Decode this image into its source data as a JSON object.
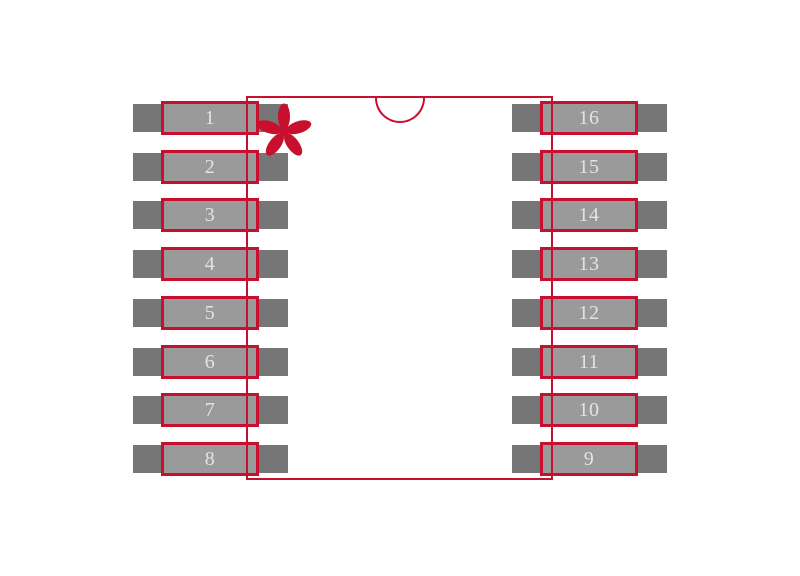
{
  "figure": {
    "left_pins": [
      "1",
      "2",
      "3",
      "4",
      "5",
      "6",
      "7",
      "8"
    ],
    "right_pins": [
      "16",
      "15",
      "14",
      "13",
      "12",
      "11",
      "10",
      "9"
    ],
    "pin1_marker_glyph": "*"
  },
  "icons": {
    "pin1_marker": "asterisk-icon",
    "pin1_end_indicator": "notch-half-circle"
  },
  "colors": {
    "background": "#ffffff",
    "annotation_red": "#c8102e",
    "pad_fill": "#767676",
    "lead_fill": "#9a9a9a",
    "pin_number_text": "#e3e3e3"
  }
}
